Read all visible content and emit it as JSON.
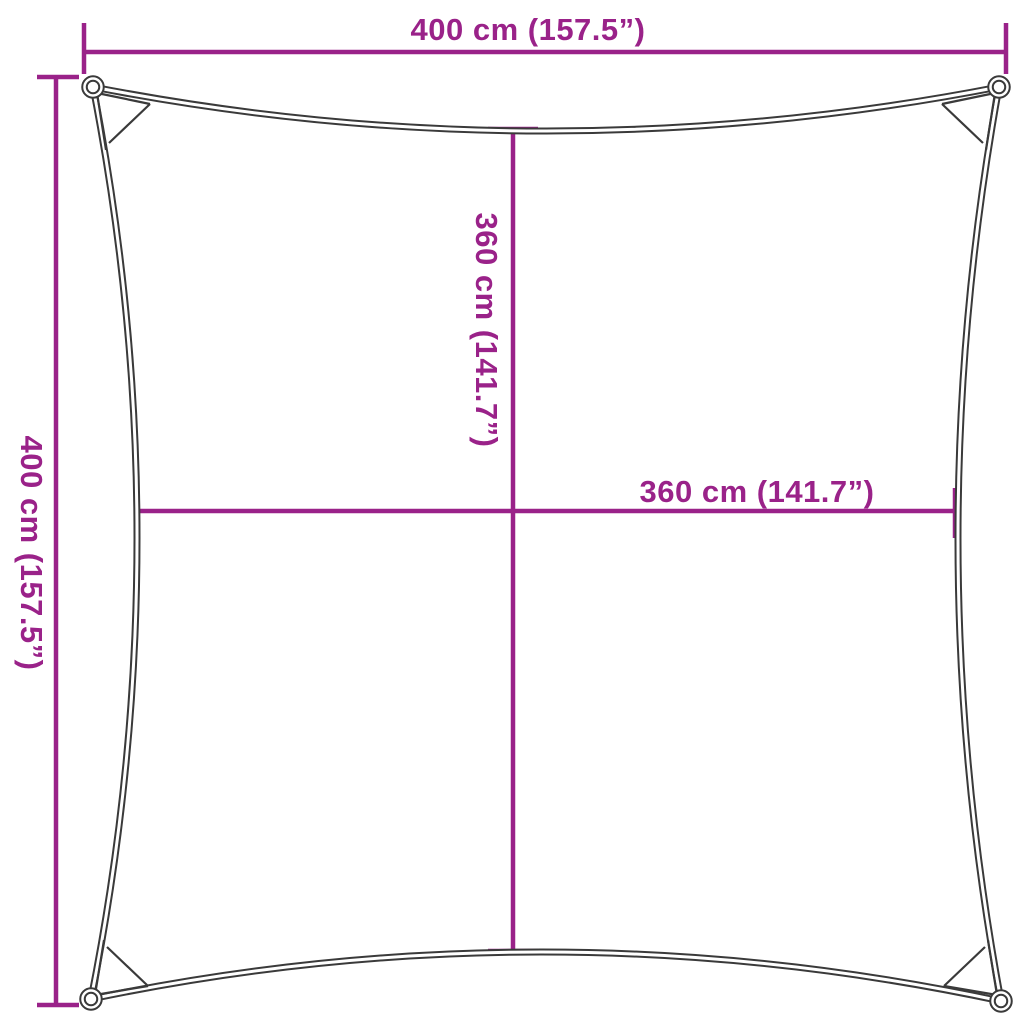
{
  "colors": {
    "accent": "#9a2289",
    "ink": "#3a3a3a",
    "background": "#ffffff"
  },
  "diagram": {
    "type": "shade-sail-dimension-diagram",
    "outer_width_label": "400 cm (157.5”)",
    "outer_height_label": "400 cm (157.5”)",
    "inner_height_label": "360 cm (141.7”)",
    "inner_width_label": "360 cm (141.7”)"
  }
}
